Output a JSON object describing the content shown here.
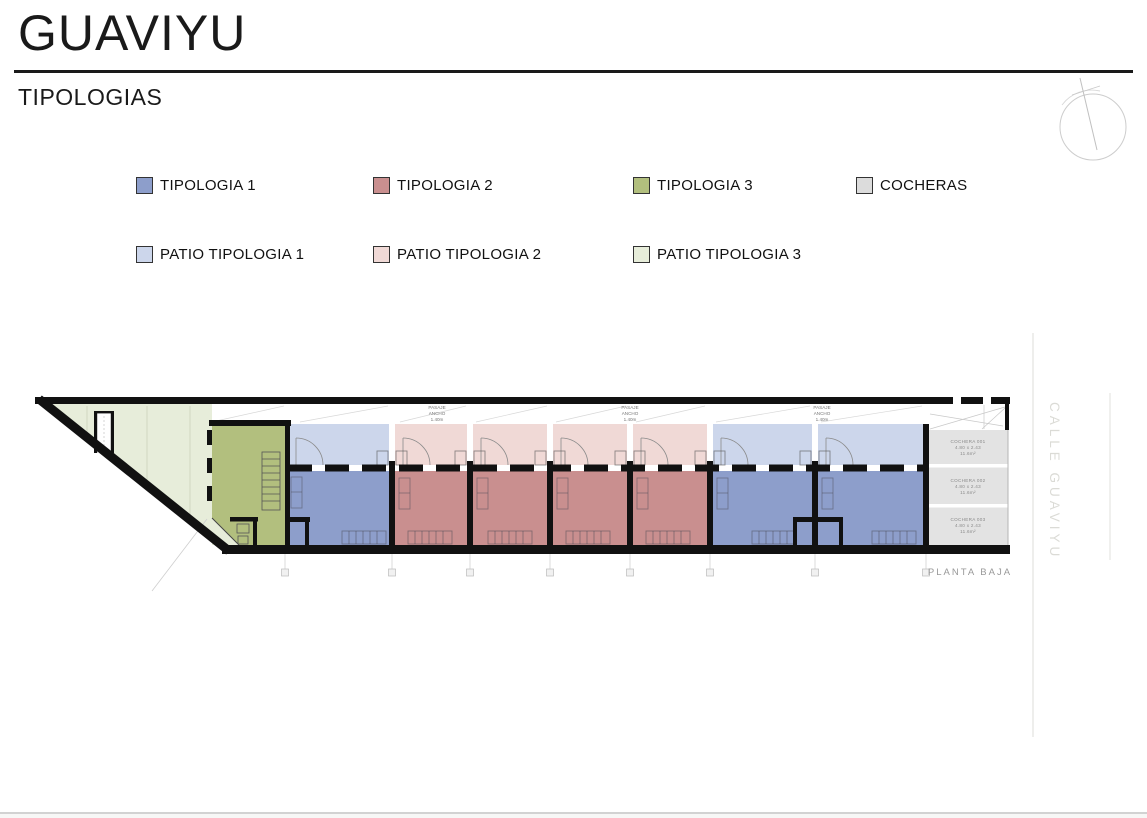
{
  "page": {
    "title": "GUAVIYU",
    "subtitle": "TIPOLOGIAS"
  },
  "legend": {
    "row1": [
      {
        "label": "TIPOLOGIA 1",
        "color": "#8d9ecb"
      },
      {
        "label": "TIPOLOGIA 2",
        "color": "#c98f8f"
      },
      {
        "label": "TIPOLOGIA 3",
        "color": "#b2bf7e"
      },
      {
        "label": "COCHERAS",
        "color": "#dcdcdc"
      }
    ],
    "row2": [
      {
        "label": "PATIO TIPOLOGIA 1",
        "color": "#ccd6eb"
      },
      {
        "label": "PATIO TIPOLOGIA 2",
        "color": "#f0d9d6"
      },
      {
        "label": "PATIO TIPOLOGIA 3",
        "color": "#e7edda"
      }
    ]
  },
  "plan": {
    "passage": {
      "line1": "PASAJE",
      "line2": "ANCHO",
      "line3": "1.40m"
    },
    "cocheras": [
      {
        "name": "COCHERA 001",
        "dims": "4.80 x 2.43",
        "area": "11.6m²"
      },
      {
        "name": "COCHERA 002",
        "dims": "4.80 x 2.43",
        "area": "11.6m²"
      },
      {
        "name": "COCHERA 003",
        "dims": "4.80 x 2.43",
        "area": "11.6m²"
      }
    ],
    "floor_label": "PLANTA BAJA",
    "street_label": "CALLE GUAVIYU",
    "units": [
      "TIPOLOGIA 3",
      "TIPOLOGIA 1",
      "TIPOLOGIA 2",
      "TIPOLOGIA 2",
      "TIPOLOGIA 2",
      "TIPOLOGIA 2",
      "TIPOLOGIA 1",
      "TIPOLOGIA 1"
    ]
  },
  "colors": {
    "wall": "#111111",
    "unit_t1": "#8d9ecb",
    "unit_t2": "#c98f8f",
    "unit_t3": "#b2bf7e",
    "patio_t1": "#ccd6eb",
    "patio_t2": "#f0d9d6",
    "patio_t3": "#e7edda",
    "cochera": "#e3e3e3"
  }
}
